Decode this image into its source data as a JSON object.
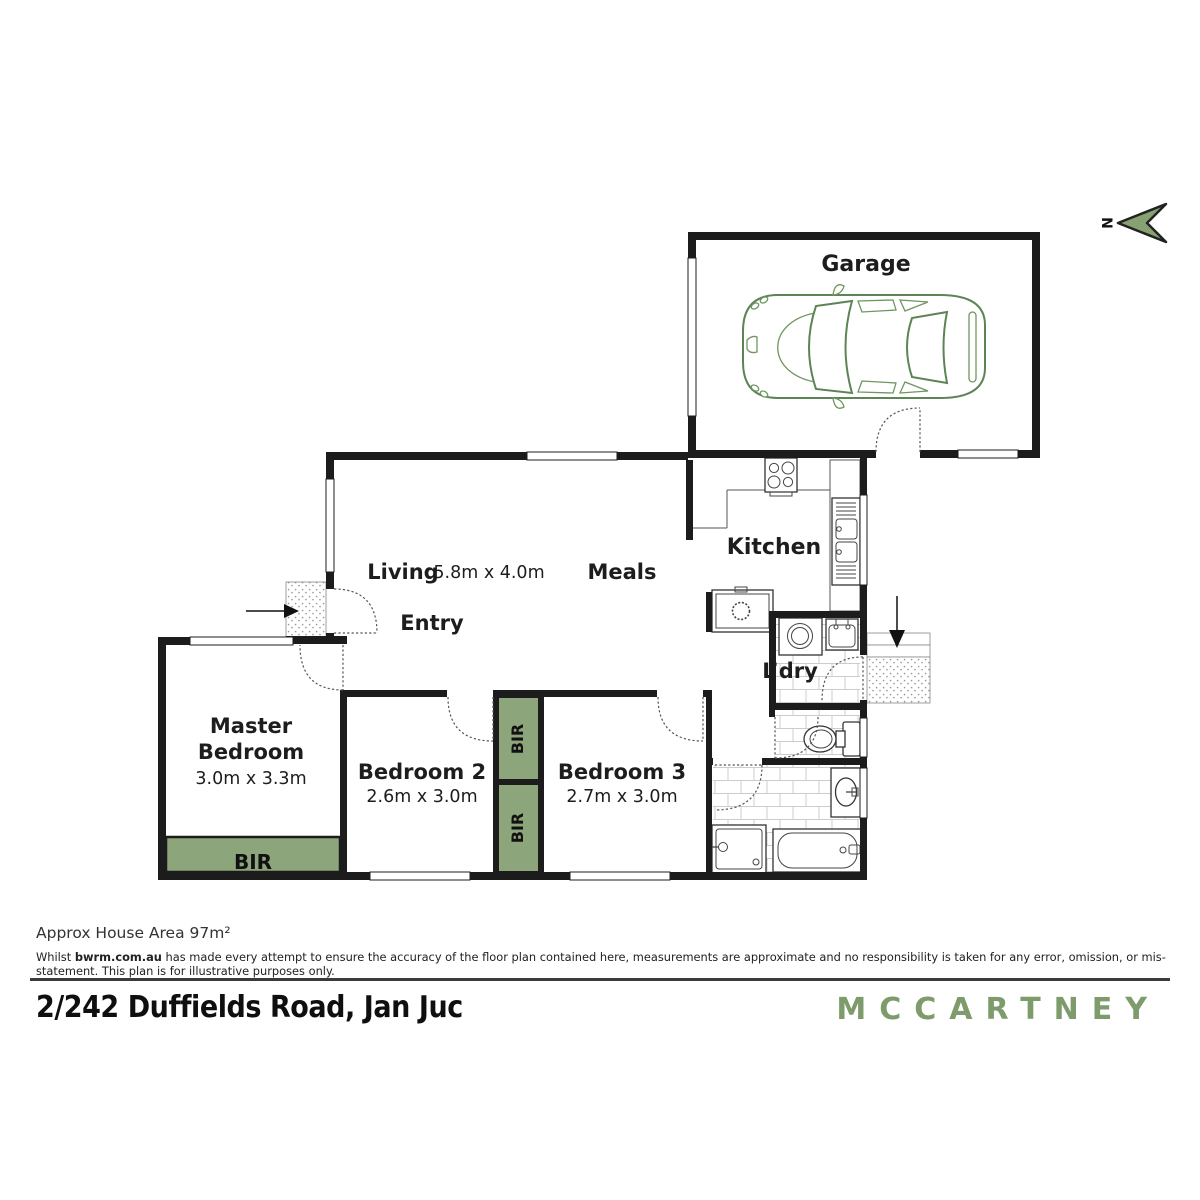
{
  "north": {
    "label": "N"
  },
  "rooms": {
    "garage": "Garage",
    "living": "Living",
    "living_meals_dims": "5.8m x 4.0m",
    "meals": "Meals",
    "entry": "Entry",
    "kitchen": "Kitchen",
    "laundry": "L’dry",
    "master_line1": "Master",
    "master_line2": "Bedroom",
    "master_dims": "3.0m x 3.3m",
    "bedroom2": "Bedroom 2",
    "bedroom2_dims": "2.6m x 3.0m",
    "bedroom3": "Bedroom 3",
    "bedroom3_dims": "2.7m x 3.0m",
    "bir_master": "BIR",
    "bir_mid_top": "BIR",
    "bir_mid_bottom": "BIR"
  },
  "footer": {
    "area_note": "Approx House Area 97m²",
    "disclaimer_prefix": "Whilst ",
    "disclaimer_brand": "bwrm.com.au",
    "disclaimer_rest": " has made every attempt to ensure the accuracy of the floor plan contained here, measurements are approximate and no responsibility is taken for any error, omission, or mis-statement. This plan is for illustrative purposes only.",
    "address": "2/242 Duffields Road, Jan Juc",
    "brand": "MCCARTNEY"
  },
  "colors": {
    "wall": "#1c1c1c",
    "bir_green": "#8ca57a",
    "logo_green": "#7d9b6b",
    "car_green": "#5d8455",
    "north_green": "#87a173"
  }
}
